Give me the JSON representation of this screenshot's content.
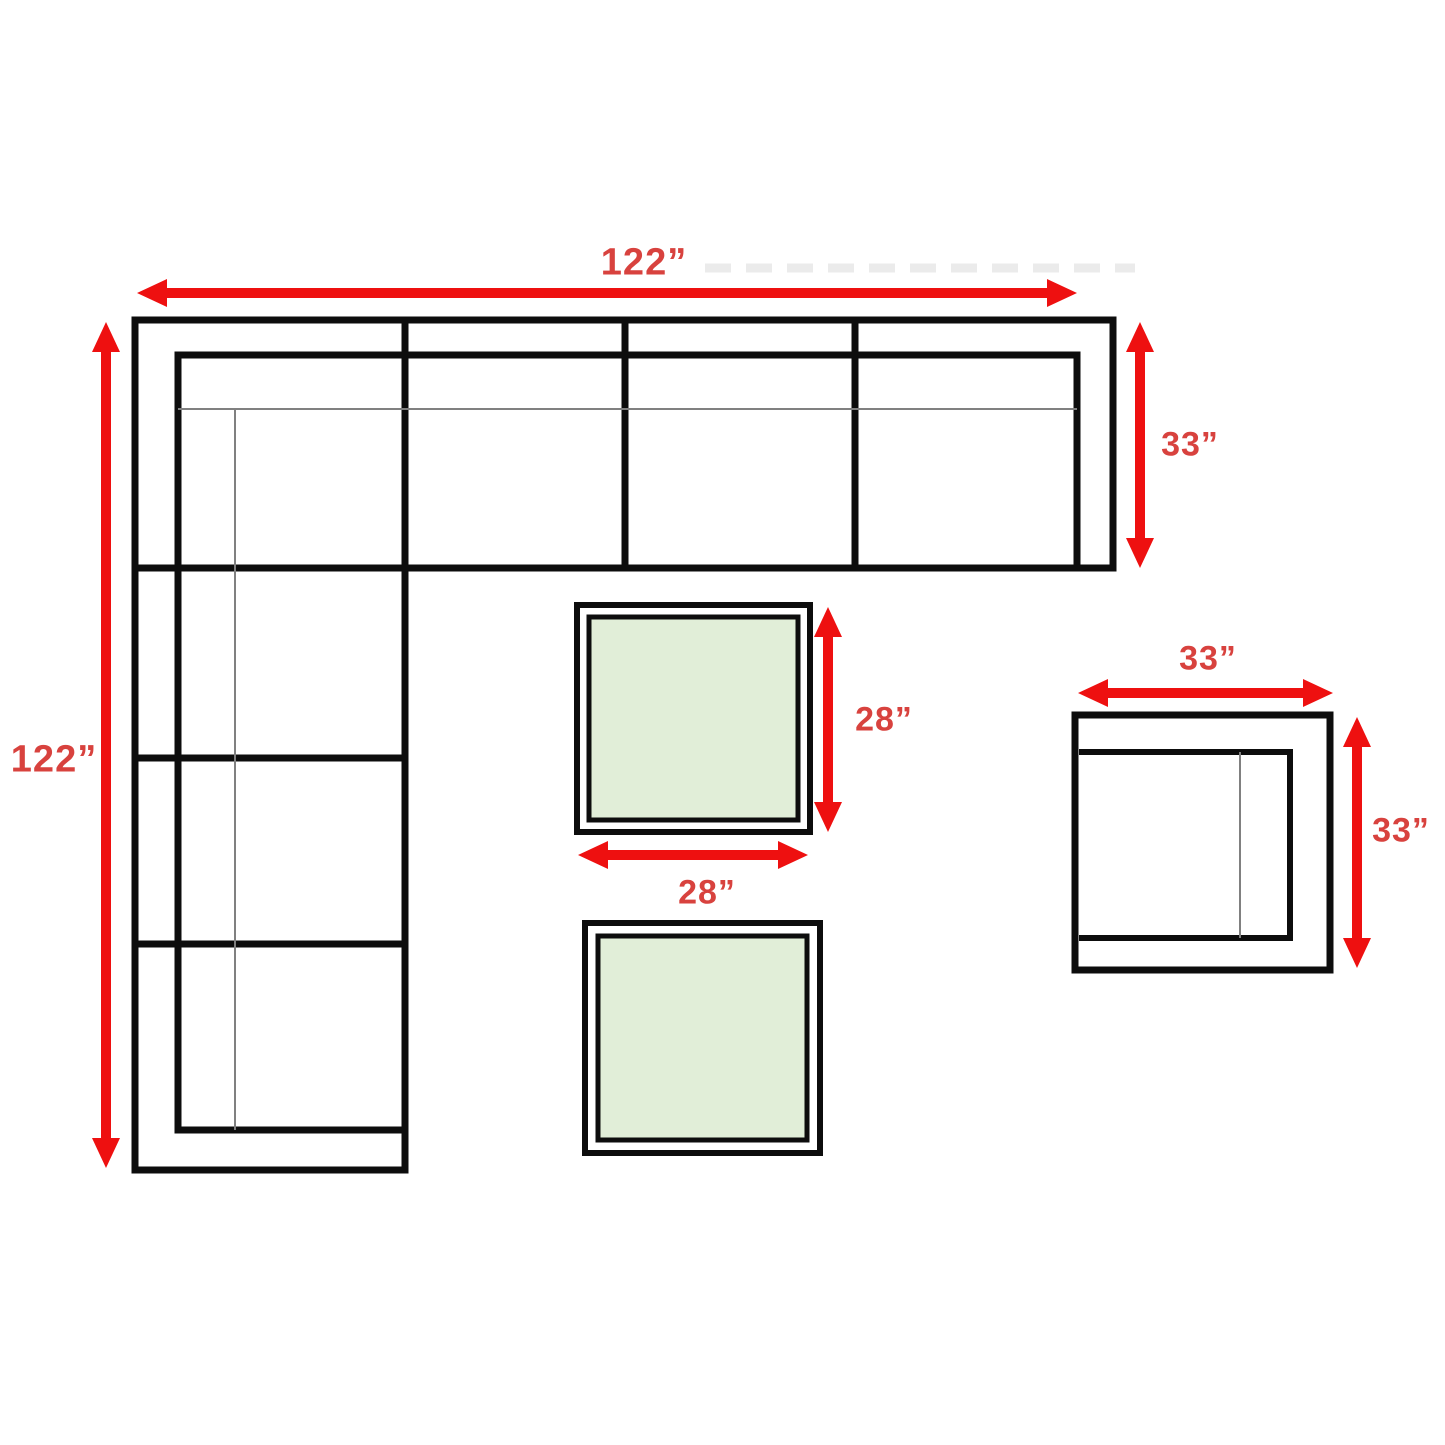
{
  "diagram": {
    "title": "sectional-sofa-set-dimension-diagram",
    "colors": {
      "arrow": "#ee1010",
      "label": "#d8423e",
      "outline": "#0d0d0d",
      "thin_line": "#808080",
      "table_fill": "#e1eed8",
      "background": "#ffffff"
    },
    "labels": {
      "sofa_width": "122”",
      "sofa_height": "122”",
      "sofa_depth": "33”",
      "table_depth": "28”",
      "table_width": "28”",
      "chair_width": "33”",
      "chair_depth": "33”"
    }
  }
}
